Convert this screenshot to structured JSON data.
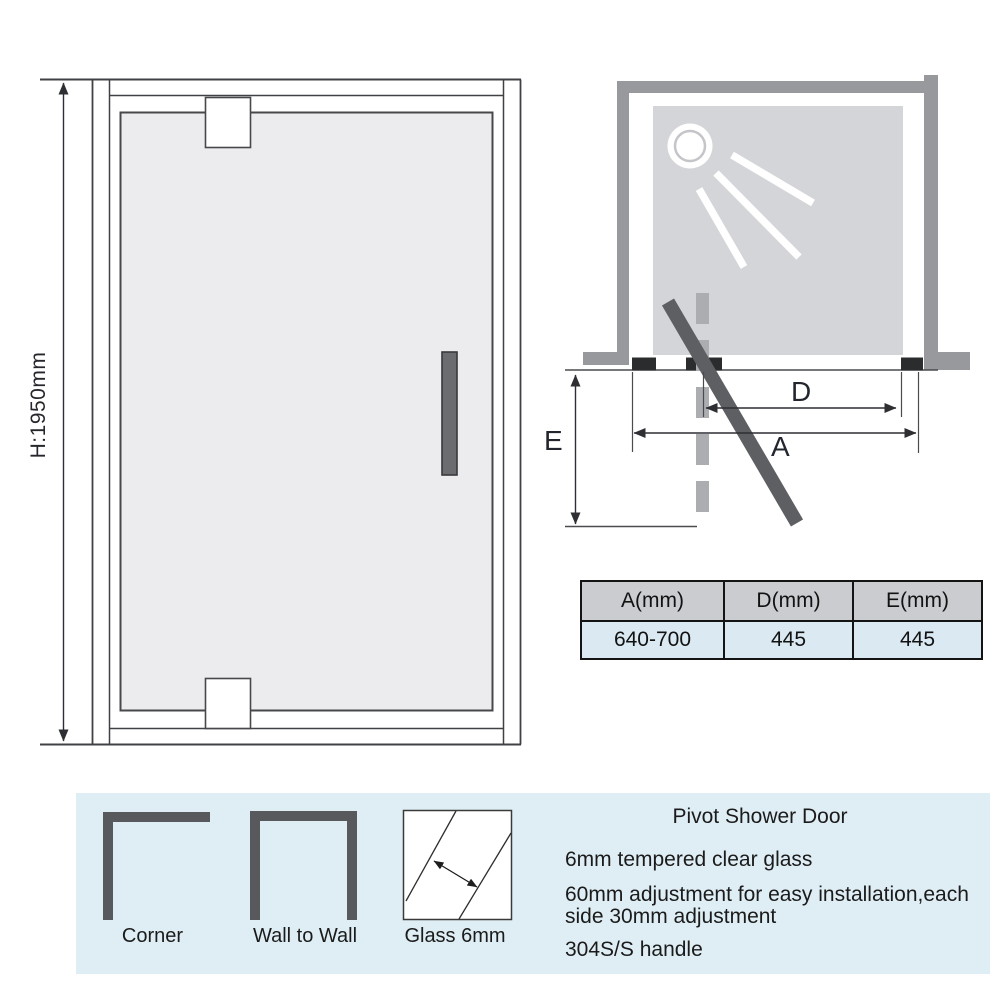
{
  "front_view": {
    "height_label": "H:1950mm"
  },
  "top_view": {
    "dim_d_label": "D",
    "dim_a_label": "A",
    "dim_e_label": "E"
  },
  "size_table": {
    "headers": [
      "A(mm)",
      "D(mm)",
      "E(mm)"
    ],
    "row": [
      "640-700",
      "445",
      "445"
    ]
  },
  "footer": {
    "installation_types": [
      {
        "label": "Corner"
      },
      {
        "label": "Wall to Wall"
      },
      {
        "label": "Glass 6mm"
      }
    ],
    "title": "Pivot Shower Door",
    "specs": [
      "6mm tempered clear glass",
      "60mm adjustment for easy installation,each\nside 30mm adjustment",
      "304S/S handle"
    ]
  },
  "colors": {
    "wall_gray": "#97999c",
    "tray_gray": "#d4d5d8",
    "glass_gray": "#ececee",
    "door_dark_gray": "#5e5f62",
    "bracket_dark": "#2b2c2e",
    "dashed_gray": "#abadb0",
    "line": "#3f4145",
    "table_header_bg": "#cacccf",
    "table_row_bg": "#dbe9f2",
    "band_bg": "#dfeef5",
    "text": "#1b1b1b"
  }
}
